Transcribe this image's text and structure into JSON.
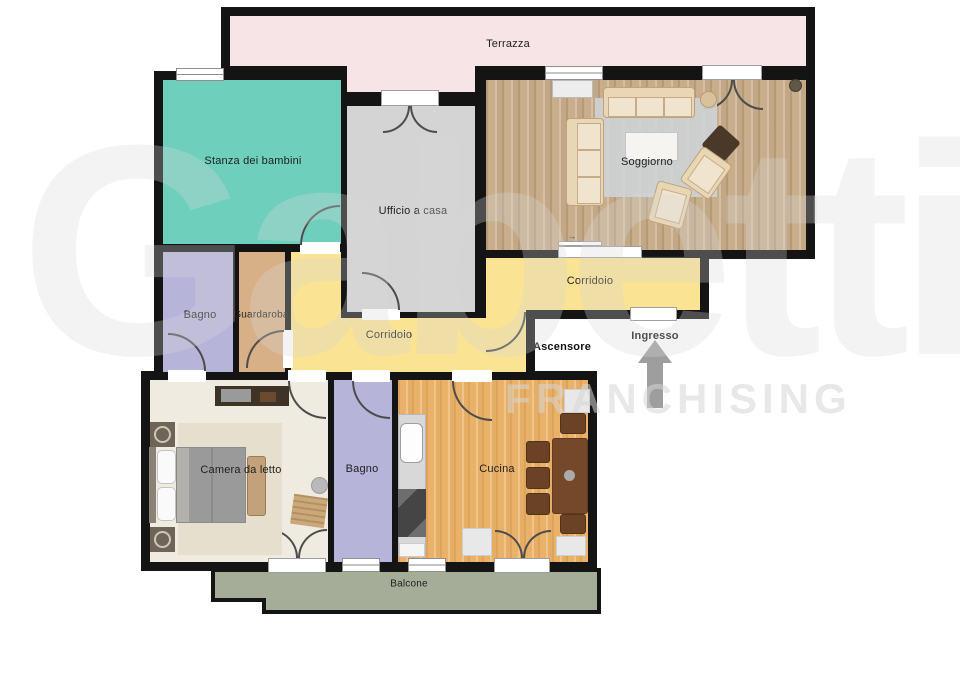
{
  "plan_title": "Apartment floor plan",
  "rooms": {
    "terrazza": {
      "label": "Terrazza"
    },
    "stanza": {
      "label": "Stanza dei bambini"
    },
    "ufficio": {
      "label": "Ufficio a casa"
    },
    "soggiorno": {
      "label": "Soggiorno"
    },
    "corridoio_est": {
      "label": "Corridoio"
    },
    "corridoio_sud": {
      "label": "Corridoio"
    },
    "bagno_nord": {
      "label": "Bagno"
    },
    "guardaroba": {
      "label": "Guardaroba"
    },
    "camera": {
      "label": "Camera da letto"
    },
    "bagno_sud": {
      "label": "Bagno"
    },
    "cucina": {
      "label": "Cucina"
    },
    "balcone": {
      "label": "Balcone"
    }
  },
  "annotations": {
    "ascensore": "Ascensore",
    "ingresso": "Ingresso",
    "sliding_arrow": "→"
  },
  "watermark": {
    "brand": "Gabetti",
    "sub": "FRANCHISING"
  },
  "colors": {
    "wall": "#141414",
    "terrace": "#f6e4e6",
    "nursery": "#6fcfbd",
    "office": "#d4d4d4",
    "corridor": "#fae393",
    "bath": "#b7b4d9",
    "wardrobe": "#d8b088",
    "bedroom_floor": "#f0ebe0",
    "bedroom_rug": "#e7dfcd",
    "living_wood": "#c9ae8c",
    "living_rug": "#ced2d6",
    "kitchen_wood": "#eab269",
    "balcony": "#a5ad99",
    "sofa": "#e9d6b4",
    "table_dark": "#76482a",
    "chair_dark": "#6b4226",
    "arrow": "#9e9e9e",
    "label": "#1f1f1f"
  }
}
